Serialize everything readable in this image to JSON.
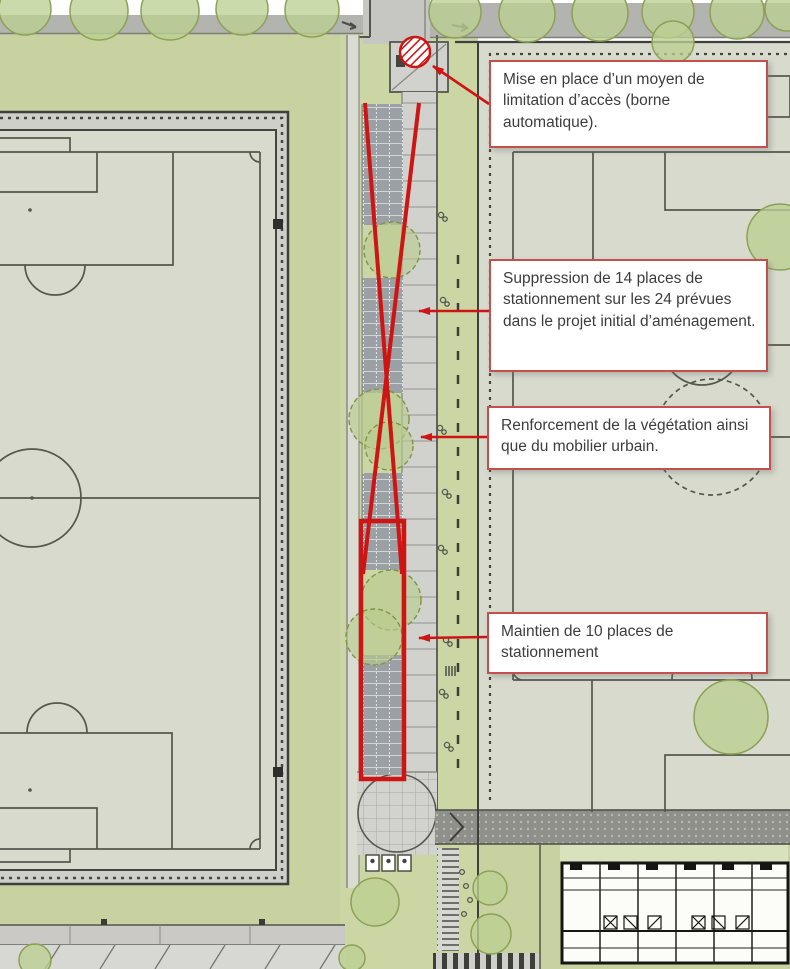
{
  "title": "Plan d'aménagement - stationnement et accès",
  "annotations": [
    {
      "id": "access-control",
      "text": "Mise en place d’un moyen de limitation d’accès (borne automatique)."
    },
    {
      "id": "parking-removal",
      "text": "Suppression de 14 places de stationnement sur les 24 prévues dans le projet initial d’aménagement."
    },
    {
      "id": "vegetation",
      "text": "Renforcement de la végétation ainsi que du mobilier urbain."
    },
    {
      "id": "parking-kept",
      "text": "Maintien de 10 places de stationnement"
    }
  ],
  "figures": {
    "places_supprimees": 14,
    "places_prevues": 24,
    "places_maintenues": 10
  },
  "map_features": [
    "left-football-pitch",
    "right-football-pitch",
    "central-parking-strip",
    "paved-lane",
    "automatic-bollard-location",
    "tree-rows",
    "speed-table",
    "pedestrian-crossing",
    "building-floor-plan",
    "bike-rack-strip"
  ],
  "colors": {
    "annotation_red": "#cf1414",
    "callout_border": "#c4504e",
    "grass": "#c7d2a0",
    "pitch": "#d7dacd",
    "road": "#b3b3af",
    "paving": "#d1d1cd",
    "parking_bay": "#9aa0a3",
    "line_dark": "#45453f"
  }
}
